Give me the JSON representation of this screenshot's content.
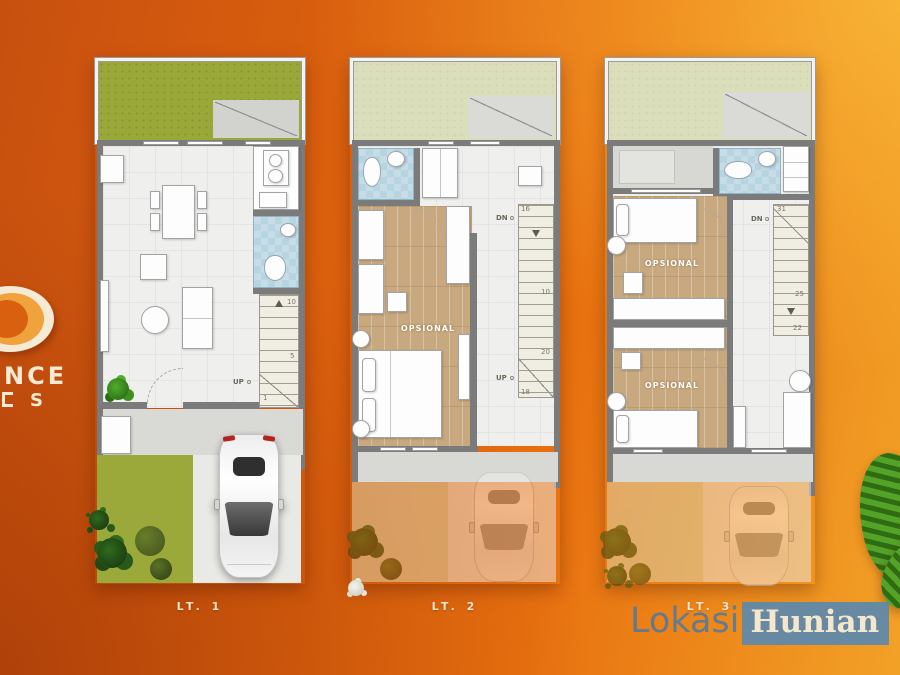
{
  "colors": {
    "background_top_right": "#f3a42a",
    "background_main": "#e8700f",
    "background_deep": "#c7500f",
    "lawn_green": "#99a838",
    "pale_green": "#dbdebb",
    "wood_floor": "#c8a97f",
    "bath_blue": "#c6dde8",
    "wall_gray": "#7b7b7b",
    "watermark_blue": "#5788b4",
    "cream": "#f5ead4"
  },
  "logo": {
    "letter_o": "O",
    "line1": "NCE",
    "line2": "S"
  },
  "plans": [
    {
      "label": "LT. 1",
      "stairs": {
        "up": "UP",
        "n_top": "10",
        "n_mid": "5",
        "n_low": "1"
      }
    },
    {
      "label": "LT. 2",
      "room": "OPSIONAL",
      "stairs": {
        "dn": "DN",
        "n16": "16",
        "n10": "10",
        "n20": "20",
        "up": "UP",
        "n18": "18"
      }
    },
    {
      "label": "LT. 3",
      "room_a": "OPSIONAL",
      "room_b": "OPSIONAL",
      "stairs": {
        "n31": "31",
        "dn": "DN",
        "n25": "25",
        "n22": "22"
      }
    }
  ],
  "watermark": {
    "part1": "Lokasi",
    "part2": "Hunian"
  }
}
